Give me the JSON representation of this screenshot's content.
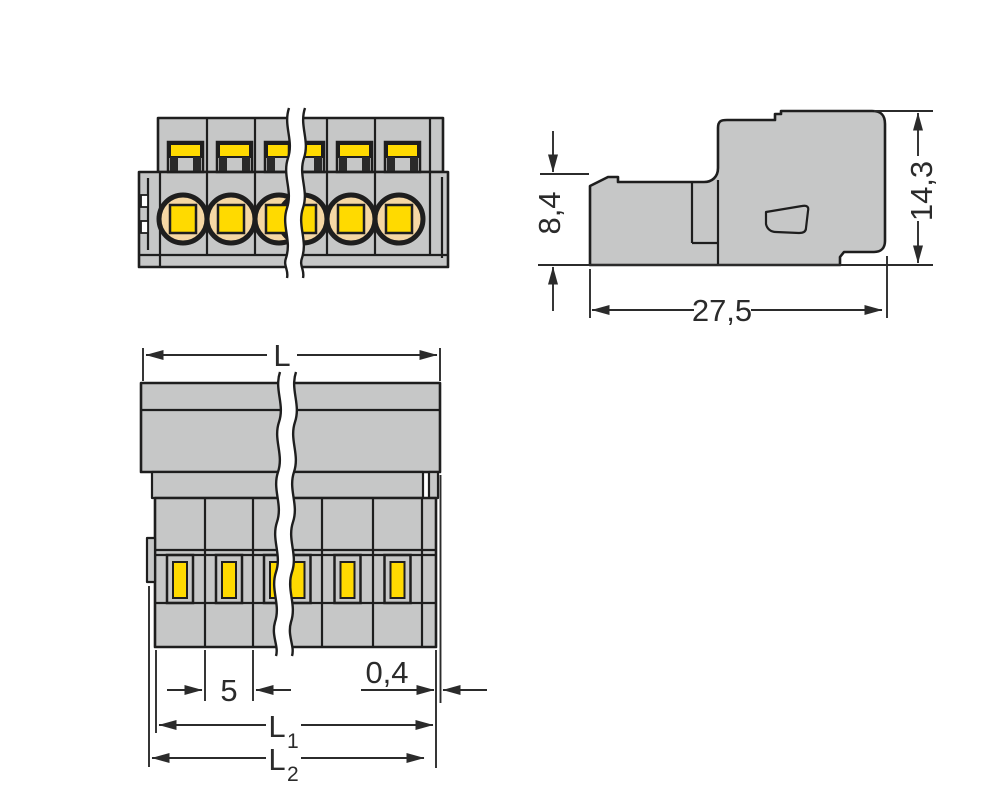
{
  "dimensions": {
    "front_height": "8,4",
    "total_height": "14,3",
    "depth": "27,5",
    "total_length_label": "L",
    "pole_pitch": "5",
    "end_offset": "0,4",
    "l1": {
      "base": "L",
      "sub": "1"
    },
    "l2": {
      "base": "L",
      "sub": "2"
    }
  },
  "colors": {
    "body_gray": "#c6c7c7",
    "slot_yellow": "#ffda00",
    "entry_peach": "#f5d7a4",
    "outline": "#1e1e1e",
    "dimension": "#2b2b2b",
    "background": "#ffffff"
  }
}
